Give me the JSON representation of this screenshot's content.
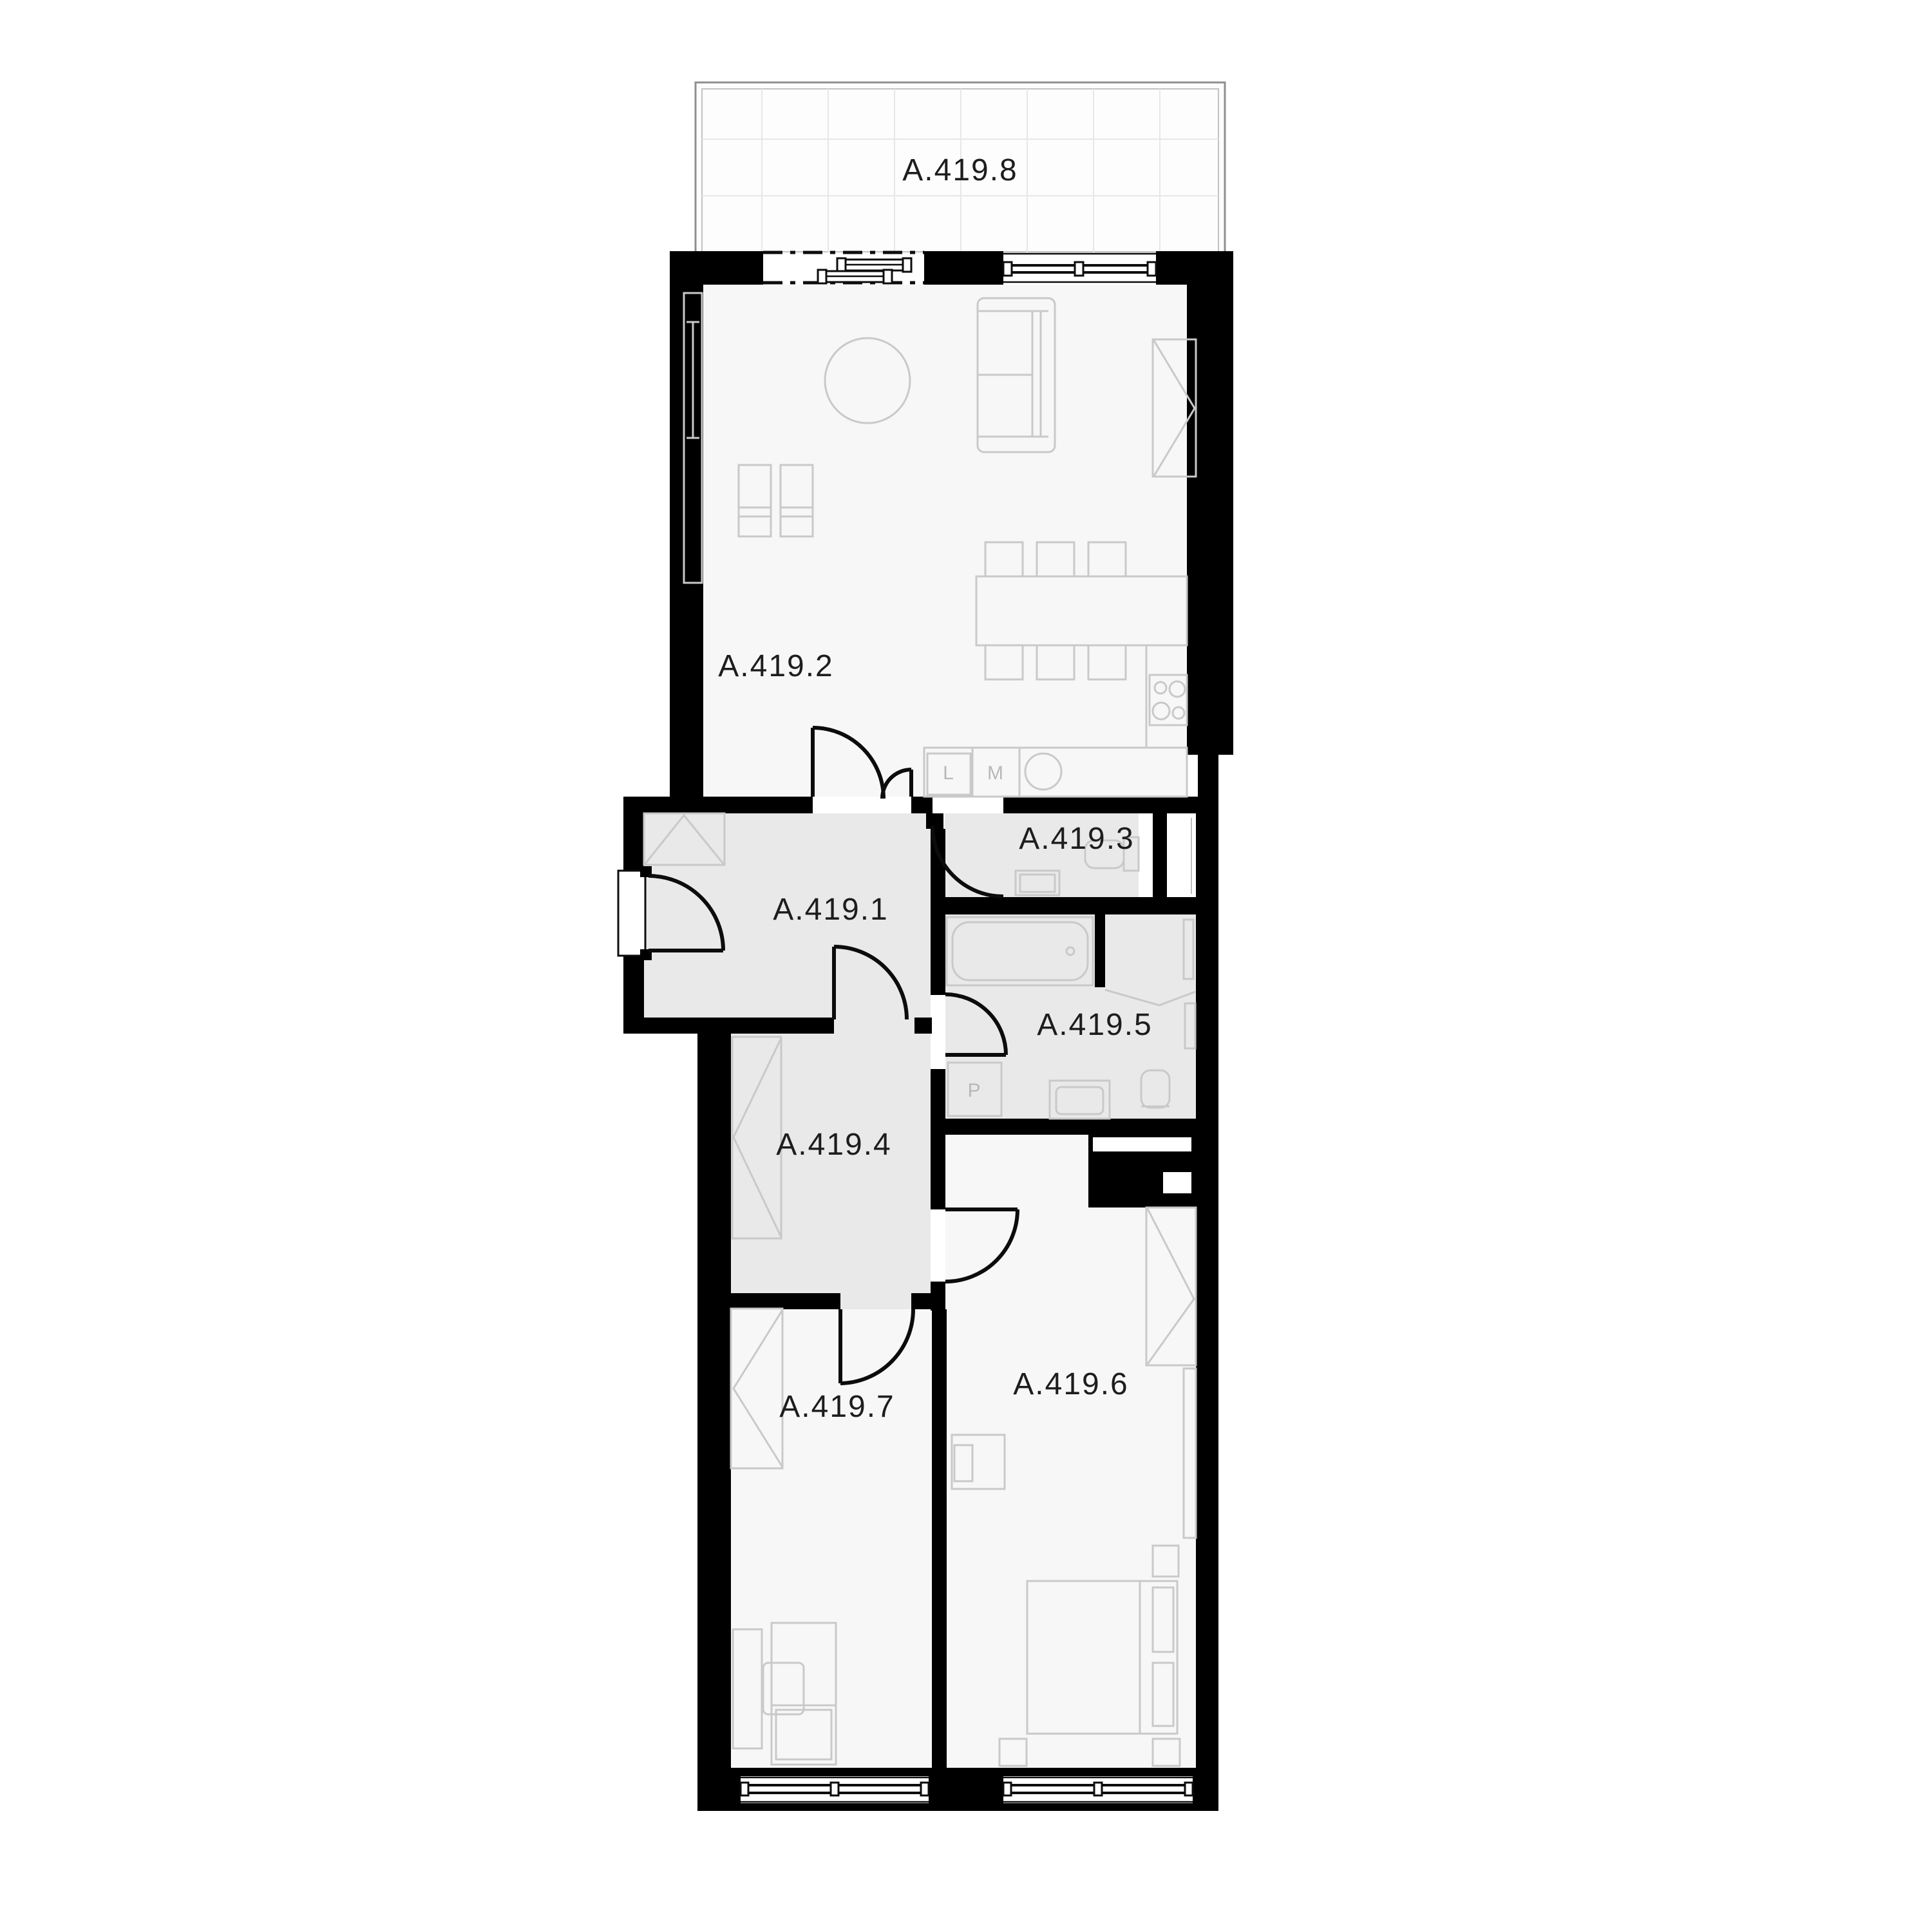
{
  "plan": {
    "type": "apartment-floor-plan",
    "unit_prefix": "A.419"
  },
  "colors": {
    "wall": "#000000",
    "floor_main": "#f7f7f7",
    "floor_secondary": "#e9e9e9",
    "furniture_stroke": "#c9c9c9",
    "label_text": "#1d1d1d",
    "appliance_text": "#b8b8b8",
    "balcony_border": "#999999",
    "balcony_grid": "#e7e7e7",
    "background": "#ffffff"
  },
  "rooms": [
    {
      "id": "hallway",
      "label": "A.419.1"
    },
    {
      "id": "living-kitchen",
      "label": "A.419.2"
    },
    {
      "id": "wc",
      "label": "A.419.3"
    },
    {
      "id": "corridor",
      "label": "A.419.4"
    },
    {
      "id": "bathroom",
      "label": "A.419.5"
    },
    {
      "id": "bedroom-1",
      "label": "A.419.6"
    },
    {
      "id": "bedroom-2",
      "label": "A.419.7"
    },
    {
      "id": "terrace",
      "label": "A.419.8"
    }
  ],
  "appliances": {
    "l": "L",
    "m": "M",
    "p": "P"
  }
}
